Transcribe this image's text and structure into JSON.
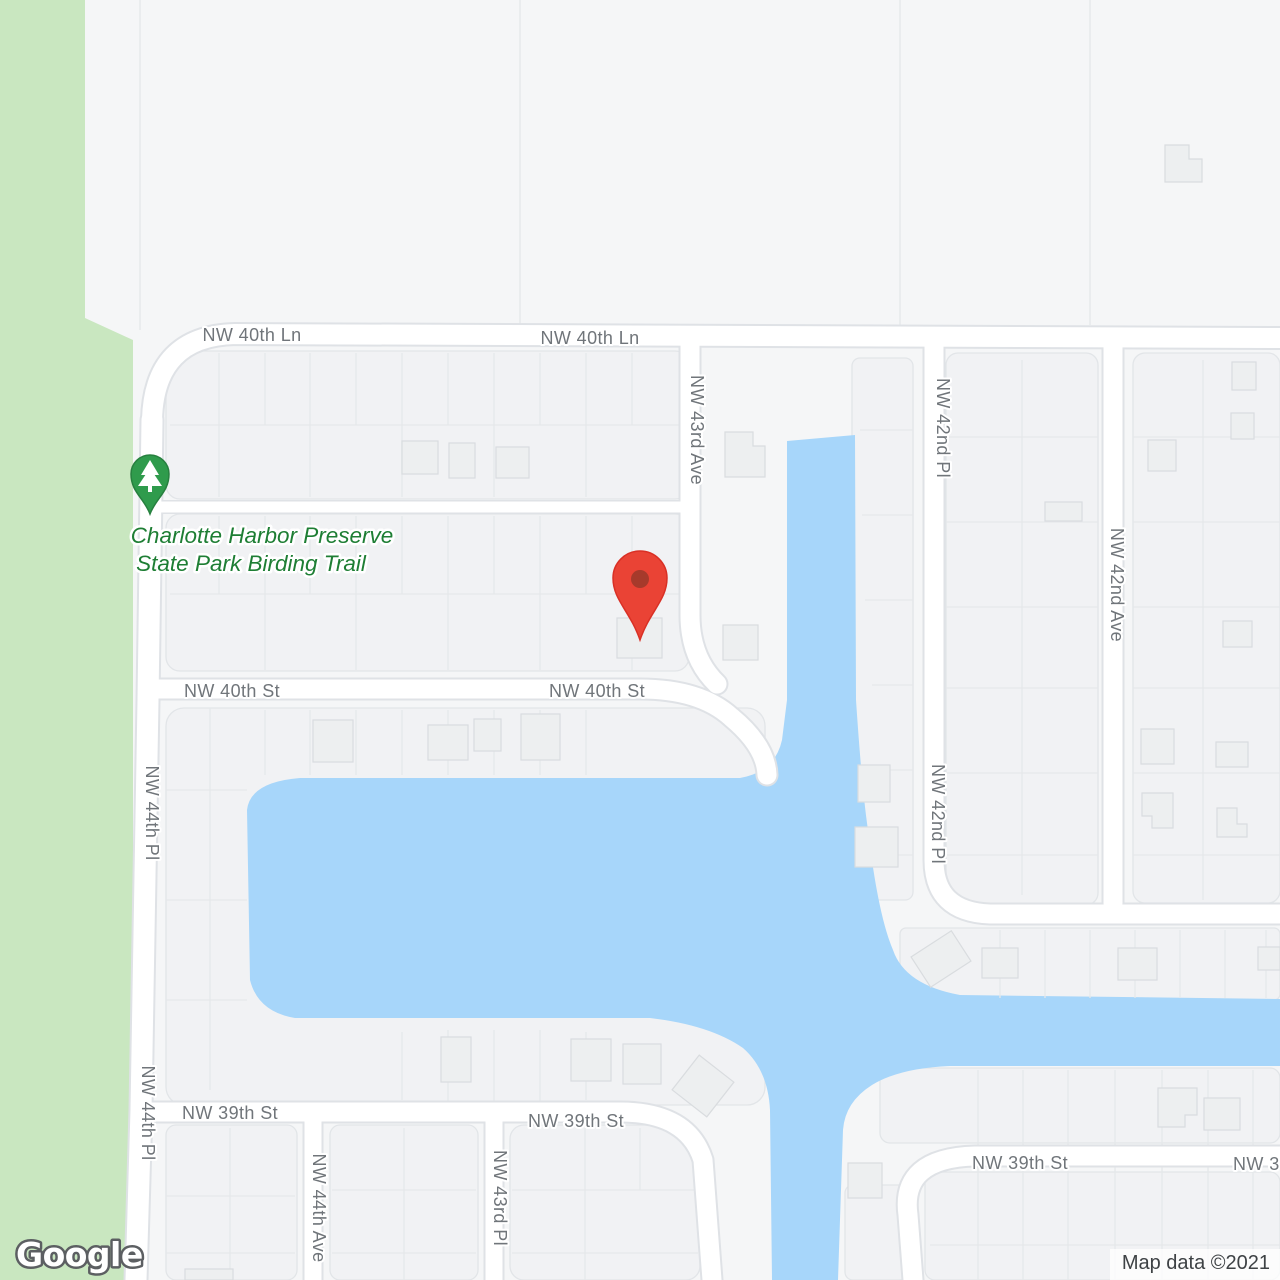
{
  "map": {
    "logo": "Google",
    "attribution": "Map data ©2021",
    "poi": {
      "park_name_line1": "Charlotte Harbor Preserve",
      "park_name_line2": "State Park Birding Trail"
    },
    "streets": {
      "nw_40th_ln": "NW 40th Ln",
      "nw_40th_st": "NW 40th St",
      "nw_39th_st": "NW 39th St",
      "nw_39th_st_partial": "NW 3",
      "nw_43rd_ave": "NW 43rd Ave",
      "nw_42nd_pl": "NW 42nd Pl",
      "nw_42nd_ave": "NW 42nd Ave",
      "nw_44th_pl": "NW 44th Pl",
      "nw_44th_ave": "NW 44th Ave",
      "nw_43rd_pl": "NW 43rd Pl"
    },
    "colors": {
      "water": "#A7D6FA",
      "park": "#C9E7C0",
      "land": "#F5F6F7",
      "street_label": "#70757A",
      "park_label": "#1E7E34",
      "pin": "#EA4335",
      "pin_inner": "#A63A2B",
      "tree_pin": "#2F9B4C",
      "attribution_text": "#3E4245"
    }
  }
}
